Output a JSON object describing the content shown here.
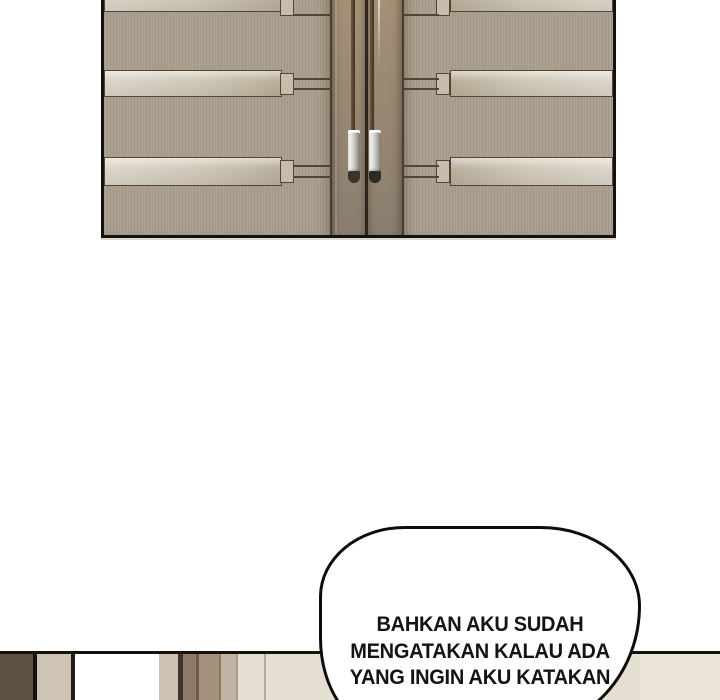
{
  "page": {
    "width": 720,
    "height": 700,
    "background": "#ffffff"
  },
  "palette": {
    "page-bg": "#ffffff",
    "panel-border": "#15120e",
    "door-field": "#a99e8d",
    "strip-light": "#ddd7cb",
    "strip-dark": "#bab09b",
    "door-outline": "#514536",
    "stile-top": "#a59278",
    "stile-bottom": "#8b7e6e",
    "stile-edge": "#4c3e2d",
    "seam": "#2c241d",
    "rod": "#3f3120",
    "handle-hi": "#f5f4f1",
    "handle-shadow": "#8d8a84",
    "handle-cap": "#3a342c",
    "bubble-outline": "#0d0d0d",
    "bubble-fill": "#ffffff",
    "text": "#141414"
  },
  "dialogue": {
    "lines": [
      "BAHKAN AKU SUDAH",
      "MENGATAKAN KALAU ADA",
      "YANG INGIN AKU KATAKAN"
    ]
  },
  "bottom_panel": {
    "stripes": [
      {
        "x": 0,
        "w": 33,
        "color": "#5e5245"
      },
      {
        "x": 33,
        "w": 4,
        "color": "#15100b"
      },
      {
        "x": 37,
        "w": 34,
        "color": "#cdc4b6"
      },
      {
        "x": 71,
        "w": 4,
        "color": "#241c14"
      },
      {
        "x": 75,
        "w": 84,
        "color": "#ffffff"
      },
      {
        "x": 159,
        "w": 19,
        "color": "#cdc3b4"
      },
      {
        "x": 178,
        "w": 5,
        "color": "#41332a"
      },
      {
        "x": 183,
        "w": 13,
        "color": "#8d7b68"
      },
      {
        "x": 196,
        "w": 3,
        "color": "#6b5a4a"
      },
      {
        "x": 199,
        "w": 20,
        "color": "#a5927d"
      },
      {
        "x": 219,
        "w": 2,
        "color": "#8a7967"
      },
      {
        "x": 221,
        "w": 15,
        "color": "#c0b5a5"
      },
      {
        "x": 236,
        "w": 2,
        "color": "#a99d8d"
      },
      {
        "x": 238,
        "w": 26,
        "color": "#e5dfd2"
      },
      {
        "x": 264,
        "w": 2,
        "color": "#b5ab9b"
      },
      {
        "x": 266,
        "w": 374,
        "color": "#e5dfd2"
      },
      {
        "x": 640,
        "w": 80,
        "color": "#ebe5d7"
      }
    ]
  }
}
